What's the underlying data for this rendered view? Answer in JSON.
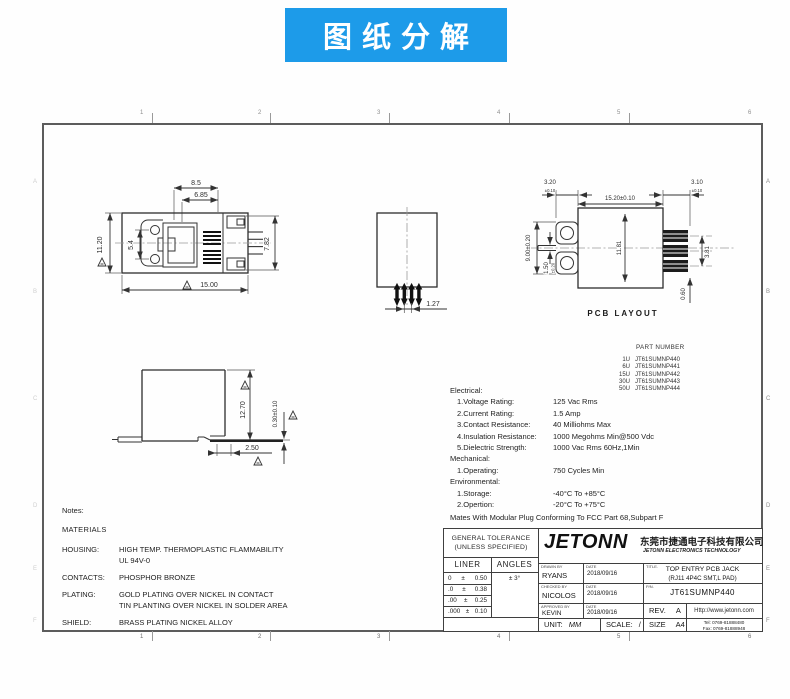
{
  "banner": {
    "title": "图纸分解"
  },
  "colors": {
    "banner_bg": "#1d9be9",
    "line": "#333333",
    "text": "#2b2b2b"
  },
  "views": {
    "top": {
      "dim_width": "8.5",
      "dim_width_inner": "6.85",
      "dim_height": "11.20",
      "dim_holes": "5.4",
      "dim_right": "7.82",
      "dim_total": "15.00"
    },
    "front": {
      "dim_pitch": "1.27"
    },
    "pcb": {
      "label": "PCB  LAYOUT",
      "dim_left_pad": "3.20",
      "tol_left_pad": "±0.10",
      "dim_width": "15.20±0.10",
      "dim_right_pad": "3.10",
      "tol_right_pad": "±0.10",
      "dim_span": "9.00±0.20",
      "dim_slot": "1.50",
      "tol_slot": "±0.20",
      "dim_height": "11.81",
      "dim_pins": "3.81",
      "dim_pad": "0.60"
    },
    "side": {
      "dim_height": "12.70",
      "dim_standoff": "0.30±0.10",
      "dim_lead": "2.50"
    }
  },
  "part_number": {
    "title": "PART NUMBER",
    "rows": [
      {
        "u": "1U",
        "pn": "JT61SUMNP440"
      },
      {
        "u": "6U",
        "pn": "JT61SUMNP441"
      },
      {
        "u": "15U",
        "pn": "JT61SUMNP442"
      },
      {
        "u": "30U",
        "pn": "JT61SUMNP443"
      },
      {
        "u": "50U",
        "pn": "JT61SUMNP444"
      }
    ]
  },
  "specs": {
    "electrical_title": "Electrical:",
    "electrical": [
      {
        "label": "1.Voltage Rating:",
        "value": "125 Vac Rms"
      },
      {
        "label": "2.Current Rating:",
        "value": "1.5 Amp"
      },
      {
        "label": "3.Contact Resistance:",
        "value": "40 Milliohms Max"
      },
      {
        "label": "4.Insulation Resistance:",
        "value": "1000 Megohms Min@500 Vdc"
      },
      {
        "label": "5.Dielectric Strength:",
        "value": "1000 Vac Rms 60Hz,1Min"
      }
    ],
    "mechanical_title": "Mechanical:",
    "mechanical": [
      {
        "label": "1.Operating:",
        "value": "750 Cycles Min"
      }
    ],
    "environmental_title": "Environmental:",
    "environmental": [
      {
        "label": "1.Storage:",
        "value": "-40°C To +85°C"
      },
      {
        "label": "2.Opertion:",
        "value": "-20°C To +75°C"
      }
    ],
    "footnote": "Mates With Modular Plug Conforming To FCC Part 68,Subpart F"
  },
  "notes": {
    "title": "Notes:",
    "materials": "MATERIALS",
    "rows": [
      {
        "label": "HOUSING:",
        "lines": [
          "HIGH TEMP. THERMOPLASTIC FLAMMABILITY",
          "UL 94V-0"
        ]
      },
      {
        "label": "CONTACTS:",
        "lines": [
          "PHOSPHOR BRONZE"
        ]
      },
      {
        "label": "PLATING:",
        "lines": [
          "GOLD PLATING OVER NICKEL IN CONTACT",
          "TIN PLANTING OVER NICKEL IN SOLDER AREA"
        ]
      },
      {
        "label": "SHIELD:",
        "lines": [
          "BRASS PLATING NICKEL ALLOY"
        ]
      }
    ]
  },
  "title_block": {
    "general_tolerance_line1": "GENERAL TOLERANCE",
    "general_tolerance_line2": "(UNLESS SPECIFIED)",
    "liner_label": "LINER",
    "angles_label": "ANGLES",
    "angle_tolerance": "± 3°",
    "tolerances": [
      {
        "digits": "0",
        "pm": "±",
        "value": "0.50"
      },
      {
        "digits": ".0",
        "pm": "±",
        "value": "0.38"
      },
      {
        "digits": ".00",
        "pm": "±",
        "value": "0.25"
      },
      {
        "digits": ".000",
        "pm": "±",
        "value": "0.10"
      }
    ],
    "logo_text": "JETONN",
    "company_cn": "东莞市捷通电子科技有限公司",
    "company_en": "JETONN ELECTRONICS TECHNOLOGY",
    "drawn_label": "DRAWN BY",
    "checked_label": "CHECKED BY",
    "approved_label": "APPROVED BY",
    "date_label": "DATE",
    "drawn_by": "RYANS",
    "drawn_date": "2018/09/16",
    "checked_by": "NICOLOS",
    "checked_date": "2018/09/16",
    "approved_by": "KEVIN",
    "approved_date": "2018/09/16",
    "unit_label": "UNIT:",
    "unit_value": "MM",
    "scale_label": "SCALE:",
    "scale_value": "/",
    "title_label": "TITLE.",
    "title_line1": "TOP ENTRY PCB JACK",
    "title_line2": "(RJ11 4P4C SMT,L PAD)",
    "pn_label": "P/N.",
    "pn_value": "JT61SUMNP440",
    "rev_label": "REV.",
    "rev_value": "A",
    "size_label": "SIZE",
    "size_value": "A4",
    "website": "Http://www.jetonn.com",
    "tel": "Tel: 0769-81888480",
    "fax": "Fax: 0769-81888948"
  },
  "zones": {
    "cols": [
      "1",
      "2",
      "3",
      "4",
      "5",
      "6"
    ],
    "rows": [
      "A",
      "B",
      "C",
      "D",
      "E",
      "F"
    ]
  }
}
